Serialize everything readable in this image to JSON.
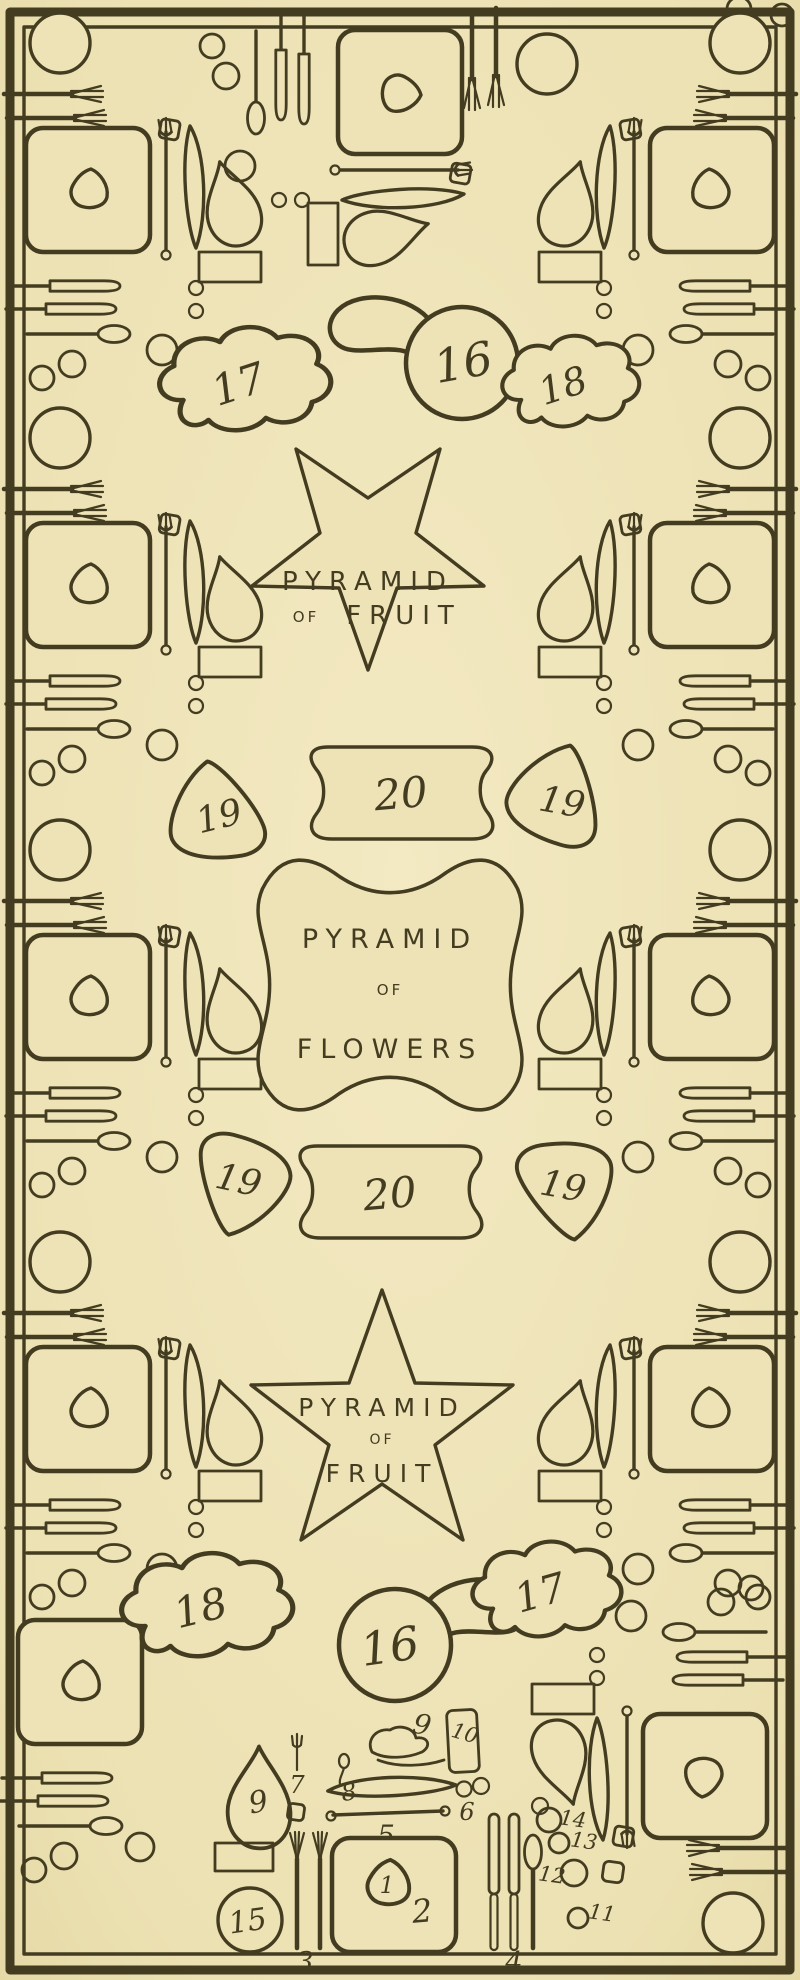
{
  "figure": {
    "kind": "vintage hand-drawn plan of a dinner table with place settings and centerpieces",
    "paper_color": "#eee3b6",
    "ink_color": "#433c20"
  },
  "centerpieces": {
    "fruit_top": {
      "l1": "PYRAMID",
      "l2": "OF",
      "l3": "FRUIT"
    },
    "flowers": {
      "l1": "PYRAMID",
      "l2": "OF",
      "l3": "FLOWERS"
    },
    "fruit_bottom": {
      "l1": "PYRAMID",
      "l2": "OF",
      "l3": "FRUIT"
    }
  },
  "numbers": {
    "n1": "1",
    "n2": "2",
    "n3": "3",
    "n4": "4",
    "n5": "5",
    "n6": "6",
    "n7": "7",
    "n8": "8",
    "n9": "9",
    "n10": "10",
    "n11": "11",
    "n12": "12",
    "n13": "13",
    "n14": "14",
    "n15": "15",
    "n16": "16",
    "n17": "17",
    "n18": "18",
    "n19": "19",
    "n20": "20"
  }
}
